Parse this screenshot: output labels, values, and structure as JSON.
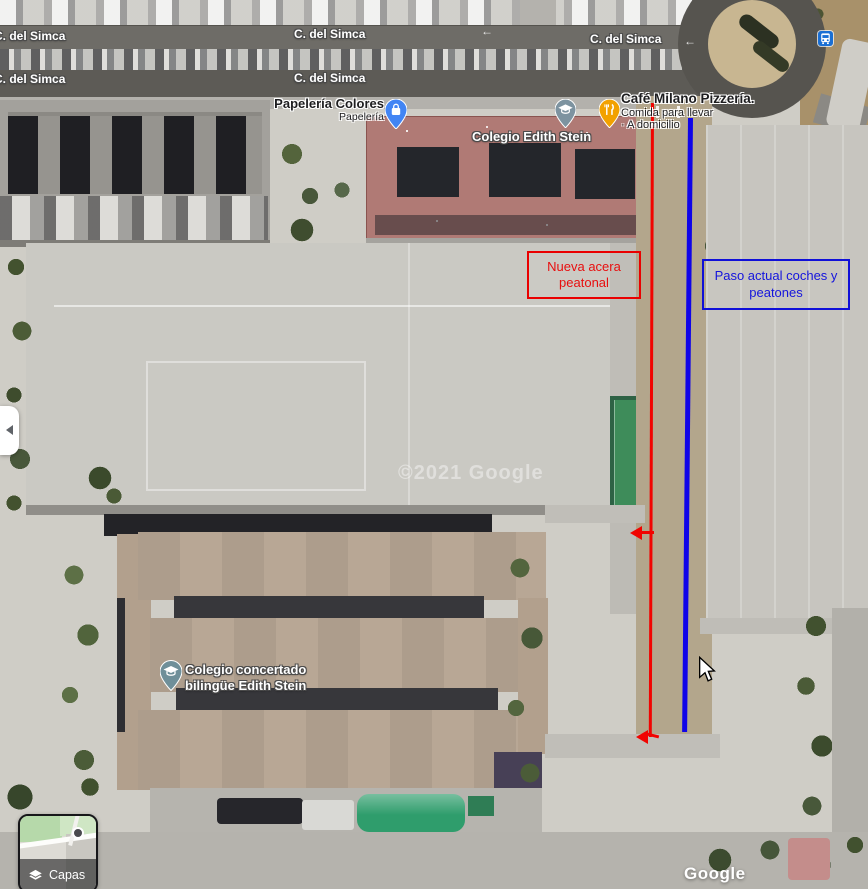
{
  "street_labels": [
    "C. del Simca",
    "C. del Simca",
    "C. del Simca",
    "C. del Simca",
    "C. del Simca"
  ],
  "road_arrows": [
    "←",
    "←"
  ],
  "pois": {
    "papeleria": {
      "title": "Papelería Colores",
      "subtitle": "Papelería"
    },
    "colegio_small": {
      "title": "Colegio Edith Stein"
    },
    "cafe": {
      "title": "Café Milano Pizzería.",
      "line2": "Comida para llevar",
      "line3": "· A domicilio"
    },
    "colegio_main": {
      "line1": "Colegio concertado",
      "line2": "bilingüe Edith Stein"
    }
  },
  "annotations": {
    "red_note": {
      "text": "Nueva acera peatonal",
      "color": "#ea0000"
    },
    "blue_note": {
      "text": "Paso actual coches y peatones",
      "color": "#1010d8"
    }
  },
  "controls": {
    "layers_label": "Capas"
  },
  "watermarks": {
    "brand": "Google",
    "copyright": "©2021 Google"
  },
  "colors": {
    "annotation_red": "#ea0000",
    "annotation_blue": "#1010d8",
    "pin_papeleria": "#4285f4",
    "pin_school": "#7d93a0",
    "pin_restaurant": "#f2a100",
    "bus_stop_icon": "#1a6fd4"
  },
  "icons": [
    "shopping-bag-pin",
    "school-pin",
    "restaurant-pin",
    "bus-stop",
    "layers",
    "collapse-arrow",
    "mouse-cursor"
  ]
}
